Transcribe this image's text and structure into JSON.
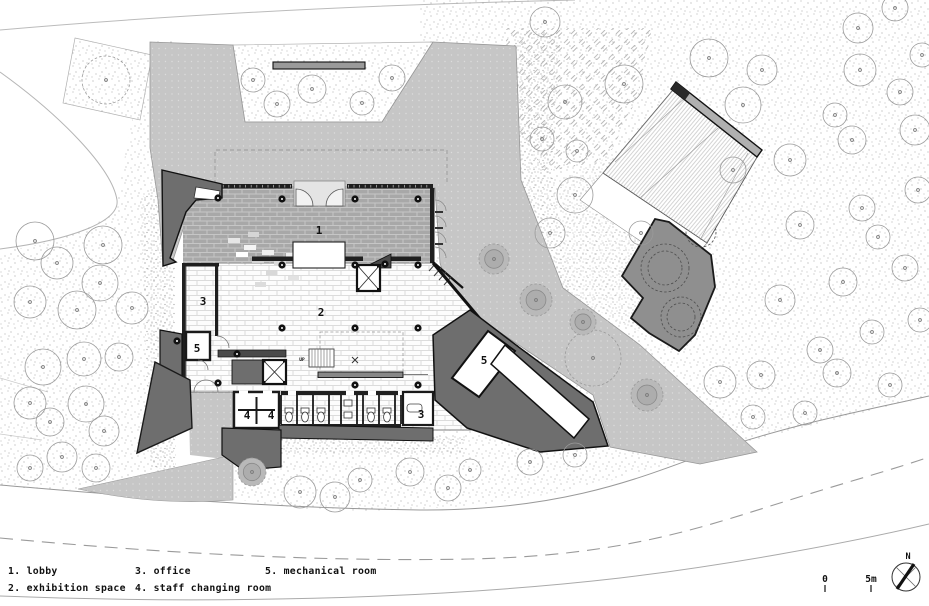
{
  "drawing": {
    "type": "architectural site / ground floor plan",
    "rooms": {
      "lobby": "1",
      "exhibition": "2",
      "office_upper": "3",
      "office_lower": "3",
      "staff_a": "4",
      "staff_b": "4",
      "mech_left": "5",
      "mech_right": "5"
    },
    "stair": {
      "up": "UP"
    }
  },
  "legend": {
    "items": [
      {
        "label": "1. lobby"
      },
      {
        "label": "2. exhibition space"
      },
      {
        "label": "3. office"
      },
      {
        "label": "4. staff changing room"
      },
      {
        "label": "5. mechanical room"
      }
    ]
  },
  "scale_bar": {
    "zero": "0",
    "five": "5m"
  },
  "compass": {
    "north": "N"
  },
  "colors": {
    "plaza": "#c6c6c6",
    "wall_poche": "#6e6e6e",
    "site_deck": "#8f8f8f",
    "lobby_floor": "#a8a8a8",
    "line": "#111111"
  }
}
